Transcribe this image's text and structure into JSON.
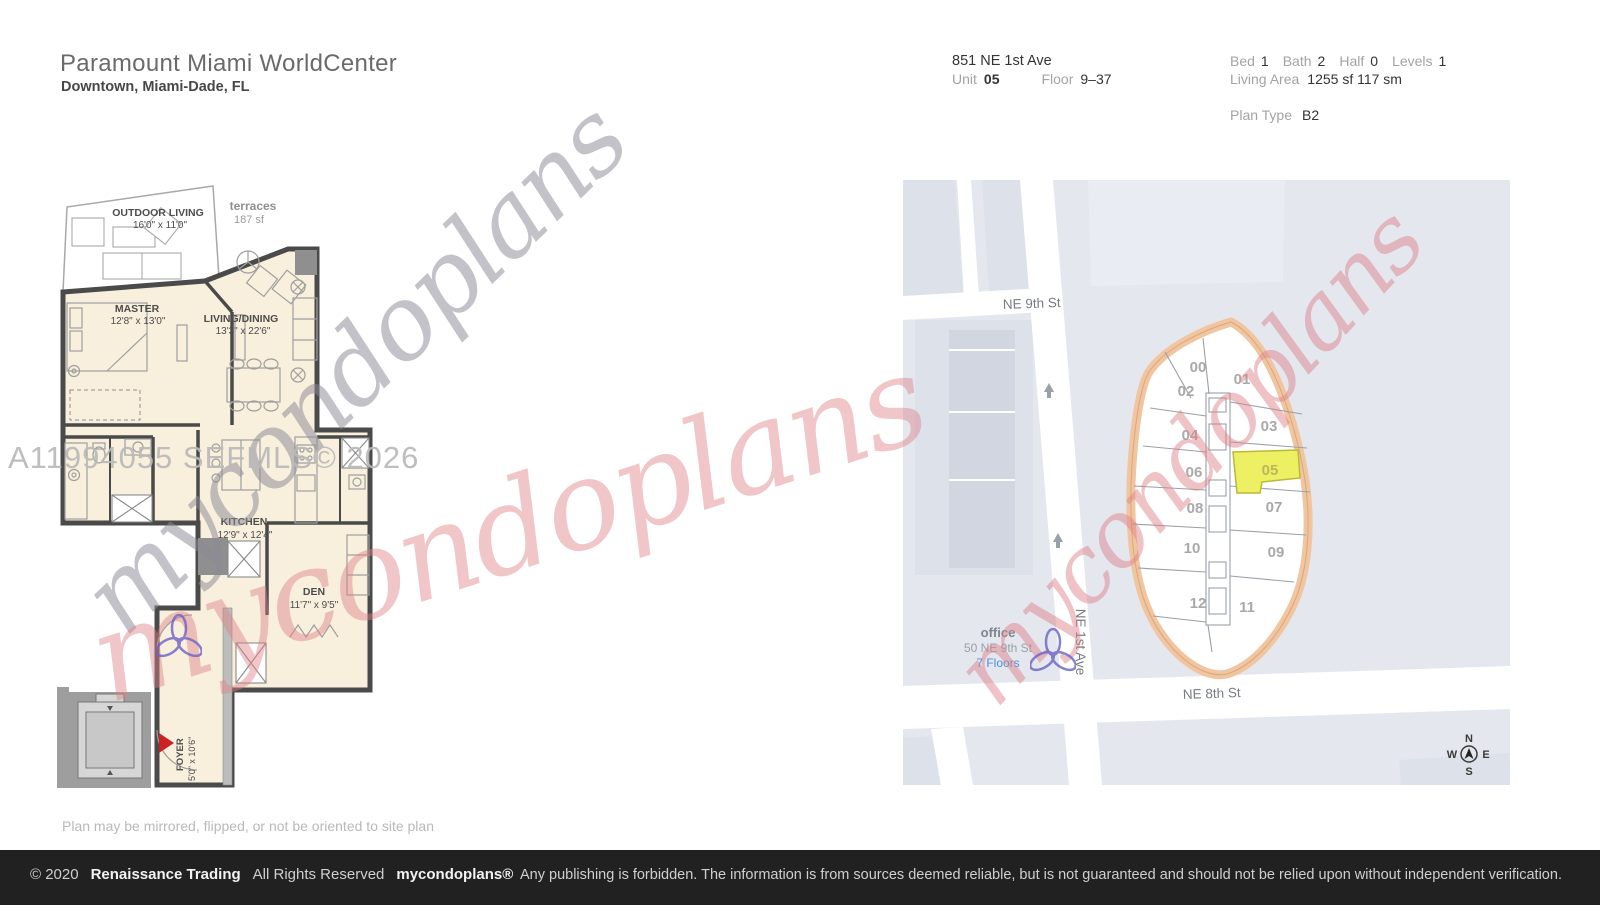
{
  "header": {
    "title": "Paramount Miami WorldCenter",
    "location": "Downtown, Miami-Dade, FL"
  },
  "info": {
    "address": "851 NE 1st Ave",
    "unit_label": "Unit",
    "unit_value": "05",
    "floor_label": "Floor",
    "floor_value": "9–37",
    "stats": [
      {
        "label": "Bed",
        "value": "1"
      },
      {
        "label": "Bath",
        "value": "2"
      },
      {
        "label": "Half",
        "value": "0"
      },
      {
        "label": "Levels",
        "value": "1"
      }
    ],
    "living_area_label": "Living Area",
    "living_area_value": "1255 sf 117 sm",
    "plan_type_label": "Plan Type",
    "plan_type_value": "B2"
  },
  "floorplan": {
    "outdoor_living": {
      "label": "OUTDOOR LIVING",
      "dims": "16'0\" x 11'0\""
    },
    "terraces": {
      "label": "terraces",
      "area": "187 sf"
    },
    "master": {
      "label": "MASTER",
      "dims": "12'8\" x 13'0\""
    },
    "living_dining": {
      "label": "LIVING/DINING",
      "dims": "13'3\" x 22'6\""
    },
    "kitchen": {
      "label": "KITCHEN",
      "dims": "12'9\" x 12'4\""
    },
    "den": {
      "label": "DEN",
      "dims": "11'7\" x 9'5\""
    },
    "foyer": {
      "label": "FOYER",
      "dims": "5'0\" x 10'6\""
    },
    "note": "Plan may be mirrored, flipped, or not be oriented to site plan"
  },
  "map": {
    "street_ne9": "NE 9th St",
    "street_ne1": "NE 1st Ave",
    "street_ne8": "NE 8th St",
    "office": {
      "name": "office",
      "address": "50 NE 9th St",
      "floors": "7 Floors"
    },
    "units": [
      "00",
      "01",
      "02",
      "03",
      "04",
      "05",
      "06",
      "07",
      "08",
      "09",
      "10",
      "11",
      "12"
    ],
    "compass": {
      "n": "N",
      "e": "E",
      "s": "S",
      "w": "W"
    }
  },
  "watermarks": {
    "mls": "A11994055  SEFMLS© 2026",
    "brand_script": "mycondoplans"
  },
  "footer": {
    "copyright": "© 2020",
    "company": "Renaissance Trading",
    "rights": "All Rights Reserved",
    "brand": "mycondoplans®",
    "disclaimer": "Any publishing is forbidden.  The information is from sources deemed reliable, but is not guaranteed and should not be relied upon without independent verification."
  },
  "colors": {
    "highlight_unit": "#eef063",
    "building_outline": "#f1c5a0",
    "link_blue": "#4a90d9",
    "footer_bg": "#212121"
  }
}
